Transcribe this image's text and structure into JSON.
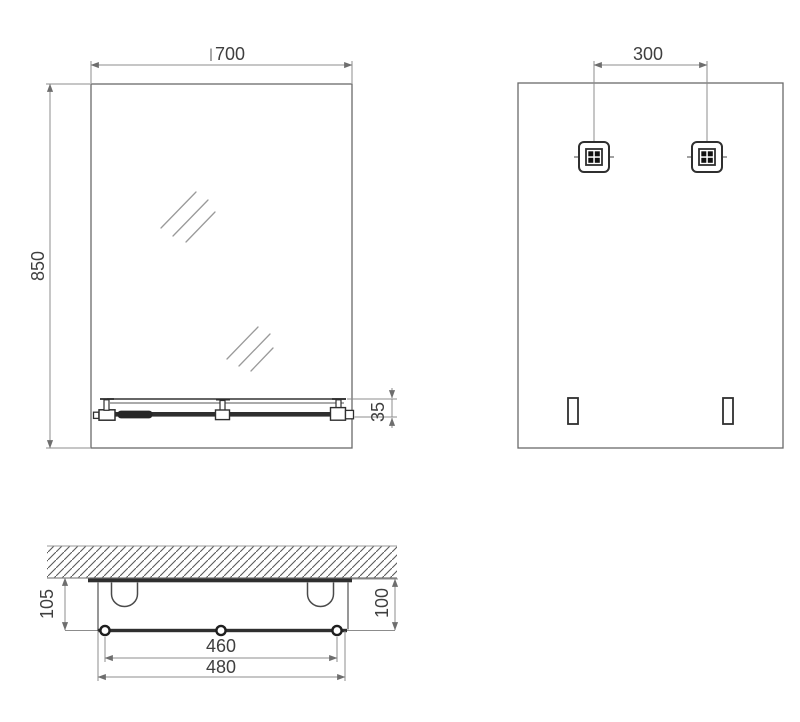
{
  "colors": {
    "background": "#ffffff",
    "outline": "#6a6a6a",
    "detail": "#2f2f2f",
    "dimension_line": "#8c8c8c",
    "text": "#3f3f3f"
  },
  "views": {
    "front": {
      "width_mm": "700",
      "height_mm": "850",
      "shelf_profile_mm": "35"
    },
    "back": {
      "hanger_spacing_mm": "300"
    },
    "bottom": {
      "wall_to_rail_mm": "105",
      "glass_to_rail_mm": "100",
      "fixings_span_mm": "460",
      "rail_length_mm": "480"
    }
  }
}
